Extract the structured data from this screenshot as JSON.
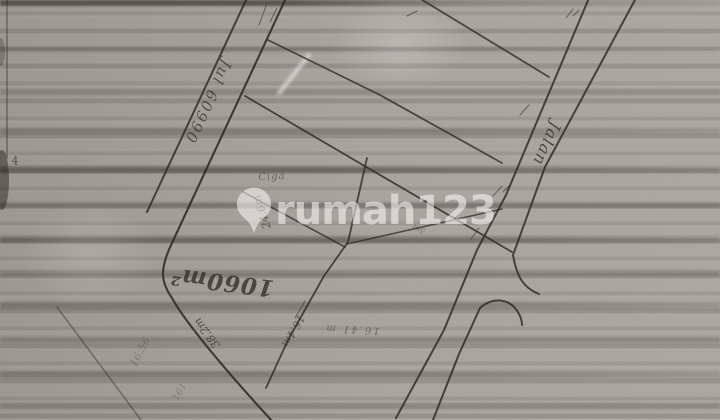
{
  "document": {
    "kind_label": "",
    "colors": {
      "paper": "#a8a49e",
      "ink": "#2a2724",
      "watermark": "#ffffff"
    }
  },
  "watermark": {
    "brand": "rumah123",
    "logo_icon": "map-pin-icon"
  },
  "annotations": {
    "road_name_left": "Jul 60990",
    "road_name_right": "Jalan",
    "area_label": "1060m²",
    "dimension_top": "24.6m",
    "dimension_frontage": "38.2m",
    "dimension_side": "16.4m",
    "dimension_bottom": "16.41 m",
    "faint_dimension_a": "16.56",
    "faint_dimension_b": "161",
    "place_note": "Ciga",
    "tiny_note": "5m",
    "margin_mark": "4"
  }
}
